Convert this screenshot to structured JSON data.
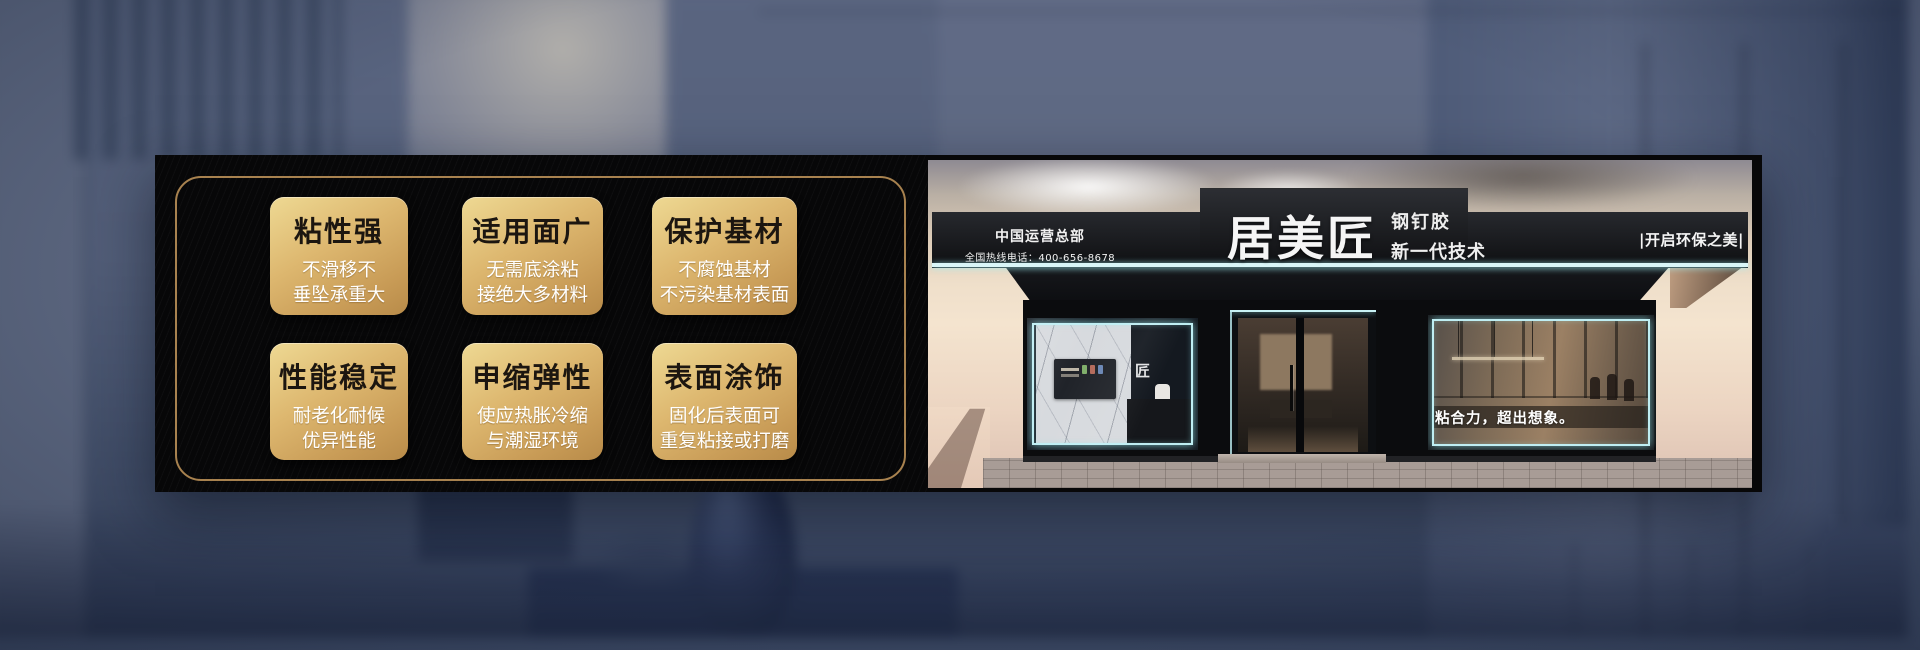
{
  "features": {
    "cards": [
      {
        "title": "粘性强",
        "line1": "不滑移不",
        "line2": "垂坠承重大"
      },
      {
        "title": "适用面广",
        "line1": "无需底涂粘",
        "line2": "接绝大多材料"
      },
      {
        "title": "保护基材",
        "line1": "不腐蚀基材",
        "line2": "不污染基材表面"
      },
      {
        "title": "性能稳定",
        "line1": "耐老化耐候",
        "line2": "优异性能"
      },
      {
        "title": "申缩弹性",
        "line1": "使应热胀冷缩",
        "line2": "与潮湿环境"
      },
      {
        "title": "表面涂饰",
        "line1": "固化后表面可",
        "line2": "重复粘接或打磨"
      }
    ]
  },
  "storefront": {
    "hq_title": "中国运营总部",
    "hotline": "全国热线电话：400-656-8678",
    "brand": "居美匠",
    "brand_sub1": "钢钉胶",
    "brand_sub2": "新一代技术",
    "right_slogan": "|开启环保之美|",
    "window_slogan": "粘合力，超出想象。",
    "logo_glyph": "匠"
  },
  "colors": {
    "gold_border": "#a8824f",
    "card_gold_light": "#eed993",
    "card_gold_dark": "#b88b49",
    "led_cyan": "#bfeef3",
    "panel_black": "#070708",
    "background_blue": "#4d5974"
  }
}
